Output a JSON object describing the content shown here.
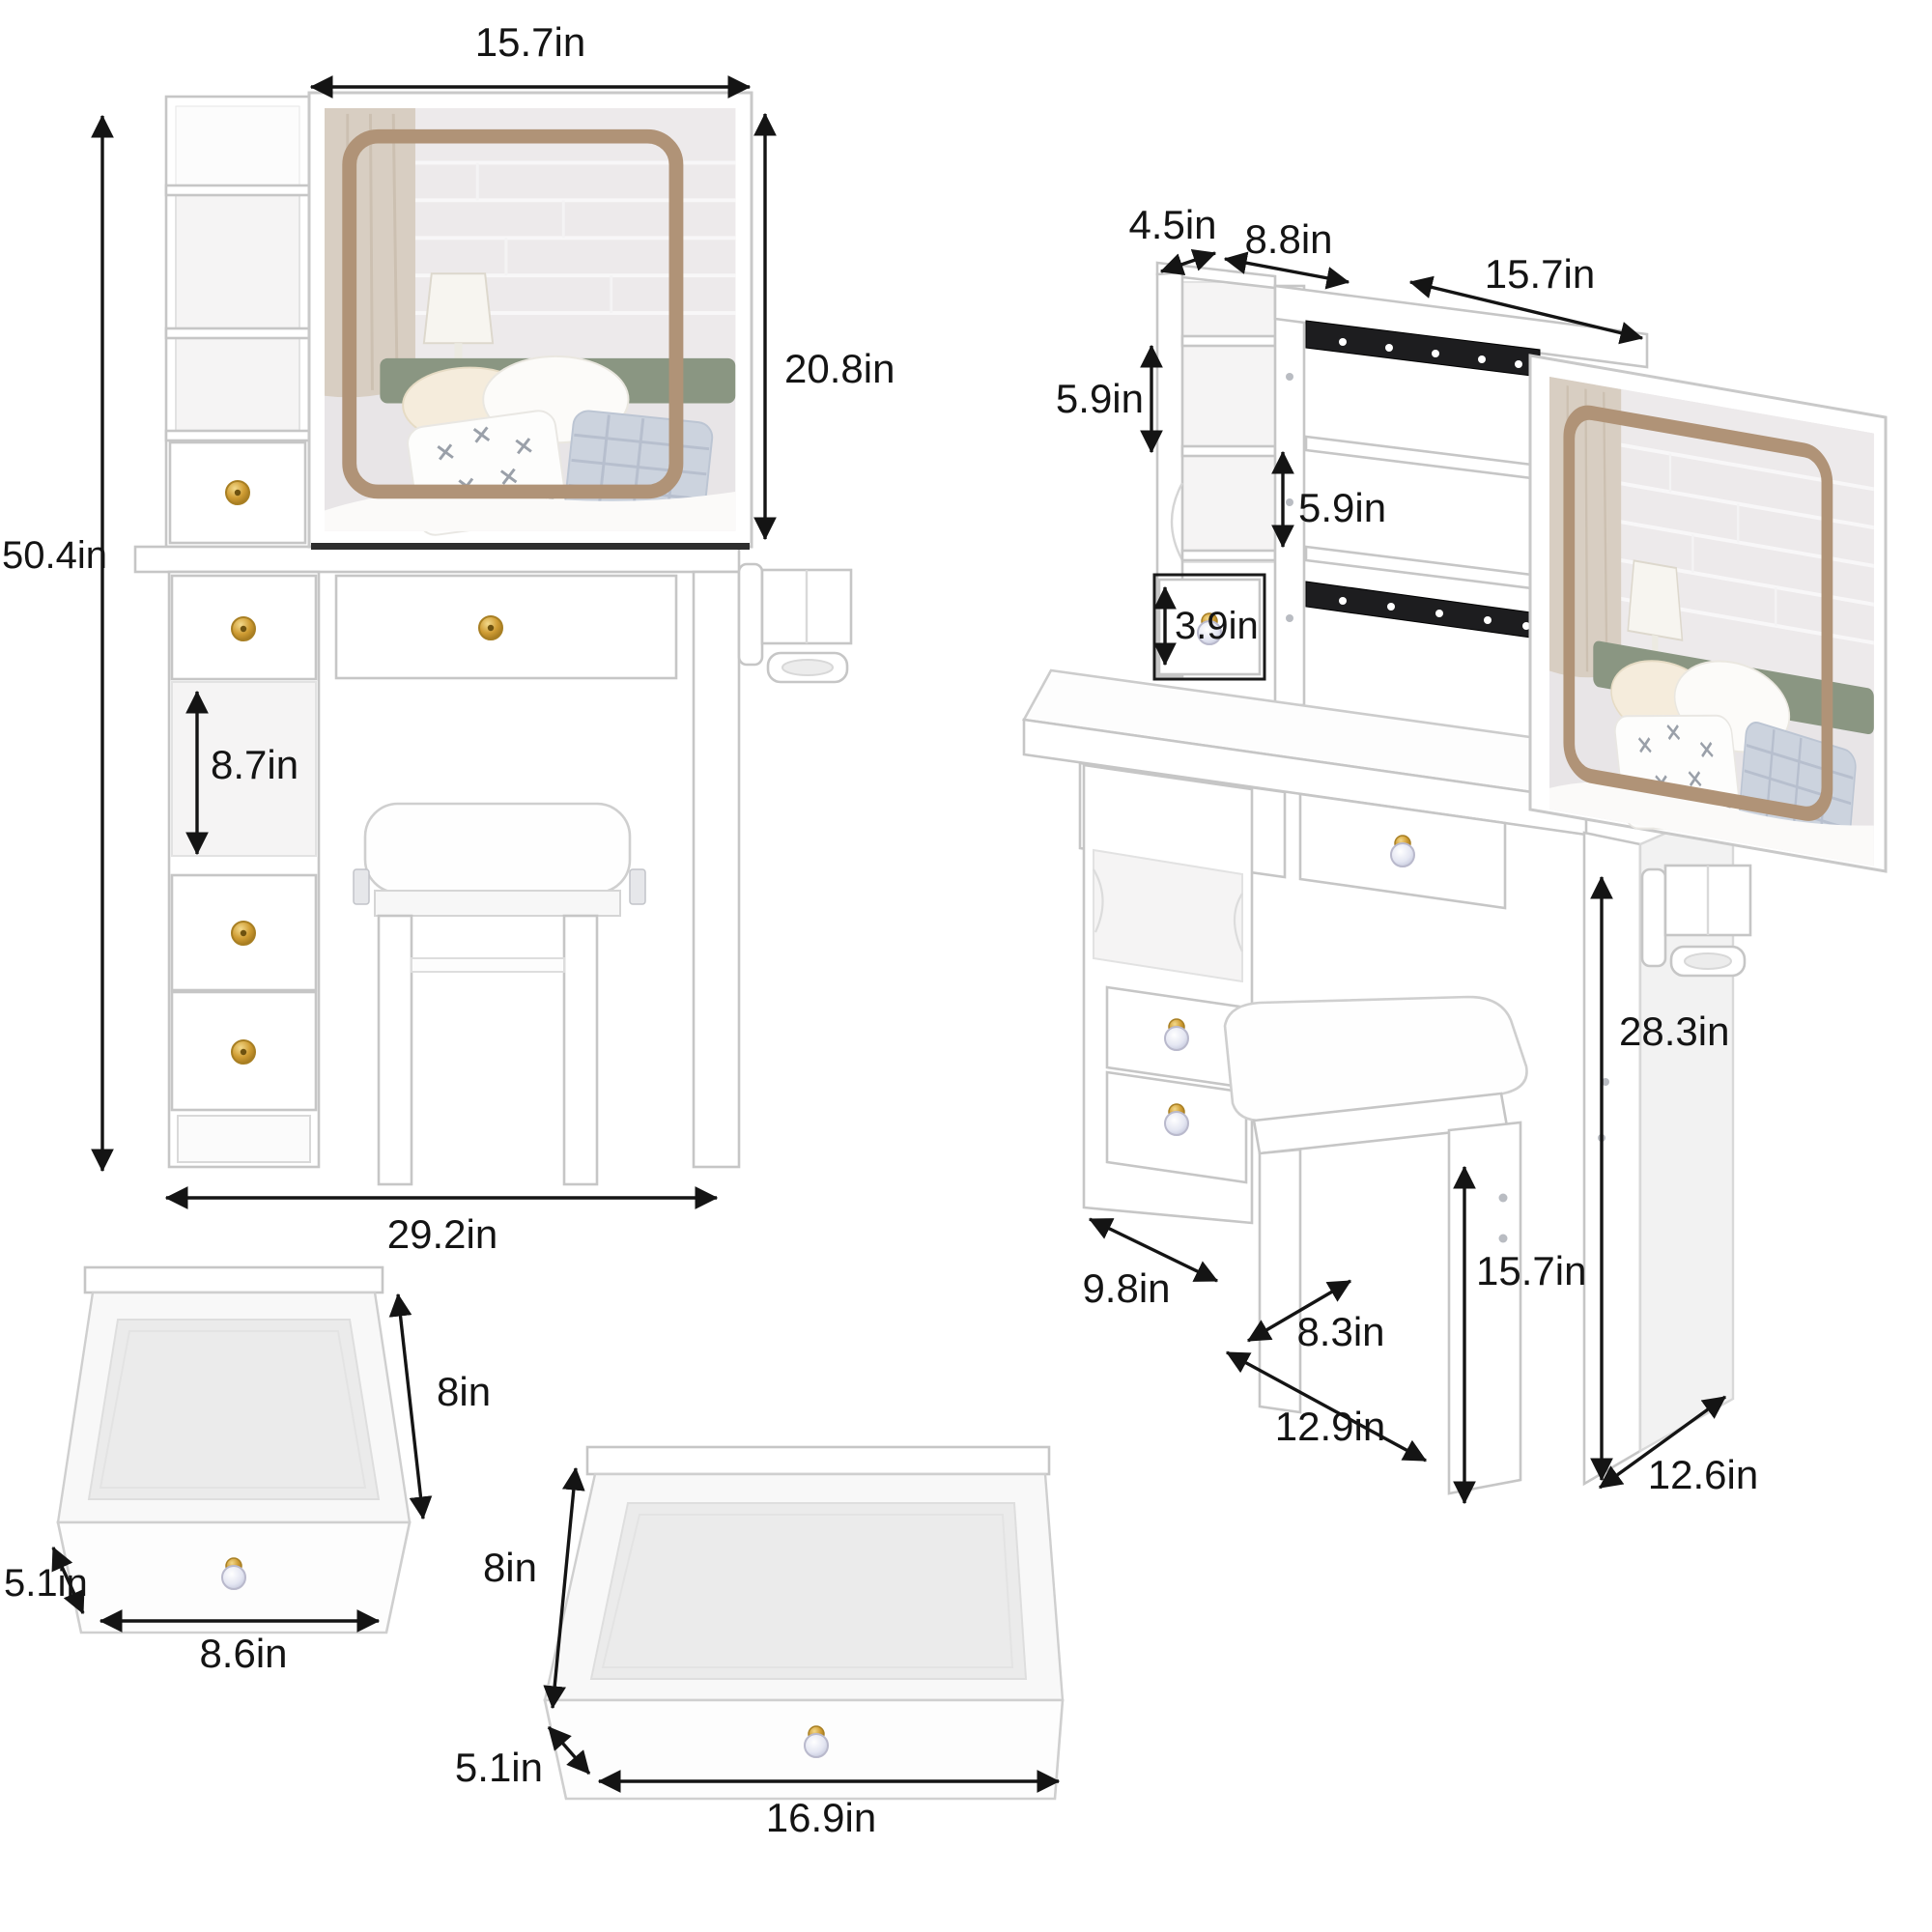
{
  "colors": {
    "background": "#ffffff",
    "dimension_text": "#141414",
    "furniture_outline": "#c6c6c6",
    "led_frame": "#b09377",
    "knob_gold": "#c9952c",
    "drawer_slide": "#1d1d1f"
  },
  "views": {
    "front_view": {
      "dimensions": {
        "mirror_width": "15.7in",
        "mirror_height": "20.8in",
        "overall_height": "50.4in",
        "open_shelf_height": "8.7in",
        "overall_width": "29.2in"
      }
    },
    "side_view": {
      "dimensions": {
        "top_shelf_depth": "4.5in",
        "hutch_shelf_width": "8.8in",
        "sliding_mirror_width": "15.7in",
        "upper_shelf_height": "5.9in",
        "lower_shelf_height": "5.9in",
        "hutch_drawer_height": "3.9in",
        "tabletop_height": "28.3in",
        "stool_height": "15.7in",
        "cabinet_depth": "9.8in",
        "stool_depth": "8.3in",
        "base_depth": "12.9in",
        "side_panel_depth": "12.6in"
      }
    },
    "small_drawer_view": {
      "dimensions": {
        "depth": "8in",
        "height": "5.1in",
        "width": "8.6in"
      }
    },
    "large_drawer_view": {
      "dimensions": {
        "depth": "8in",
        "height": "5.1in",
        "width": "16.9in"
      }
    }
  }
}
